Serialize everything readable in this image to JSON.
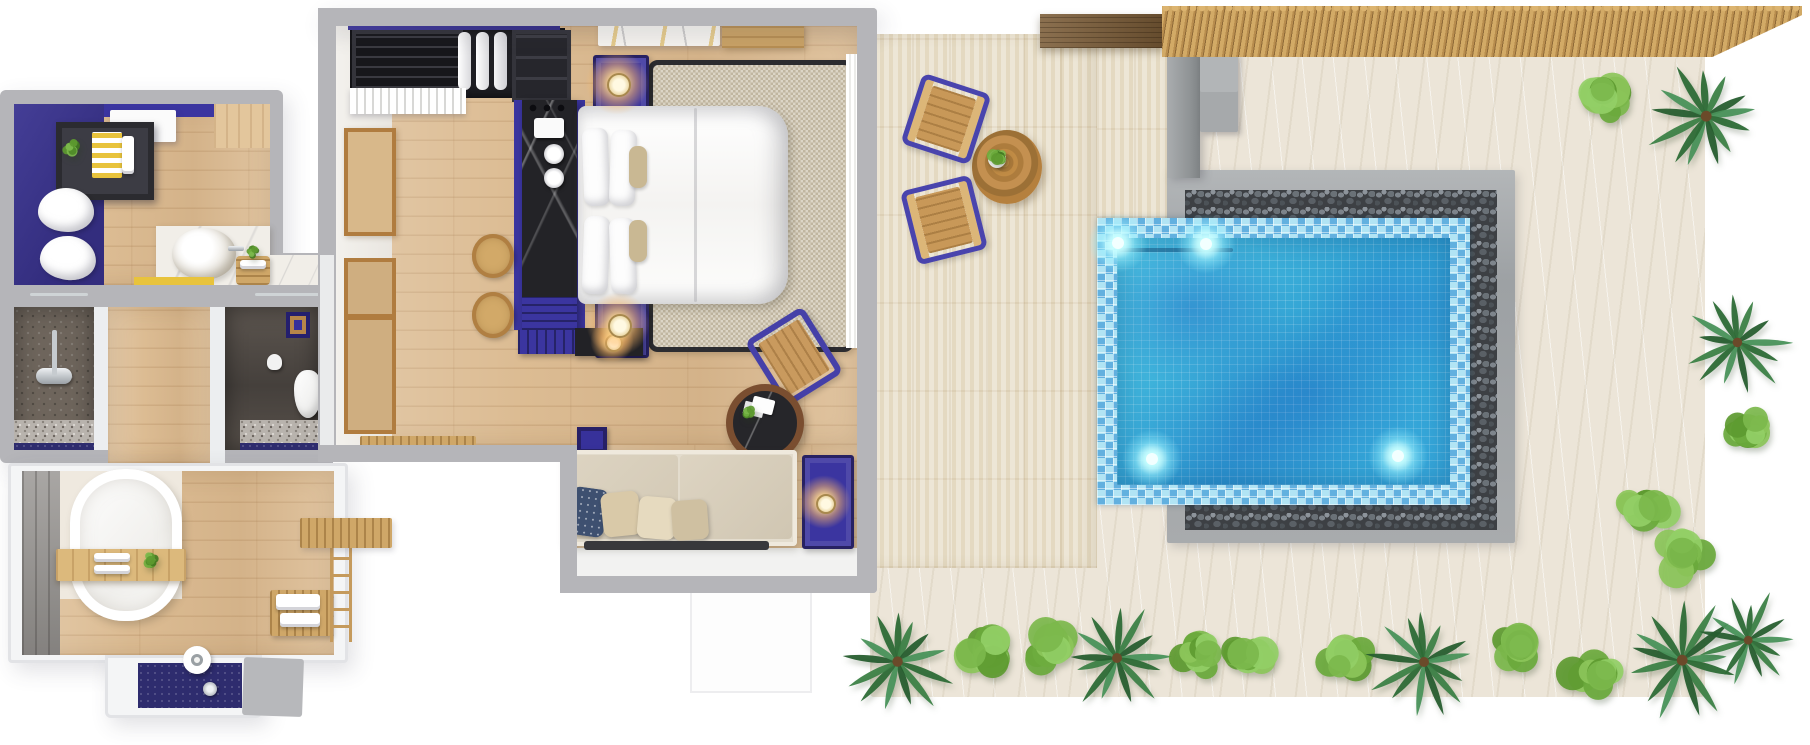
{
  "scene": {
    "type": "3d-floor-plan-render",
    "description": "Top-down 3D rendering of a one-bedroom pool villa: bathroom suite with freestanding tub and double shower rooms, bedroom with king bed and daybed sofa, travertine terrace with bistro set, bamboo-shaded sand garden with pebble-edged mosaic plunge pool and tropical planting",
    "background": "#ffffff"
  },
  "palette": {
    "wall_gray": "#b5b5b9",
    "accent_indigo": "#3b35a0",
    "indigo_dark": "#272163",
    "wood_floor": "#dcbc93",
    "travertine": "#e8dfca",
    "sand": "#ece5d8",
    "pool_water": "#35aad8",
    "pool_mosaic": "#79cde6",
    "pebble_dark": "#3d4044",
    "stone_gray": "#a8abad",
    "bamboo": "#c9a25f",
    "palm_green": "#2f6f3a",
    "shrub_green": "#7cb84c",
    "lamp_glow": "#ffd98f",
    "accent_yellow": "#e8c33c",
    "navy_tile": "#2e2c6e"
  },
  "rooms": [
    {
      "id": "vanity-bathroom",
      "name": "Vanity bathroom with robes and vessel sink"
    },
    {
      "id": "shower-room",
      "name": "Stone shower room"
    },
    {
      "id": "wc",
      "name": "Toilet room"
    },
    {
      "id": "tub-bathroom",
      "name": "Bathroom with freestanding oval tub and rain shower"
    },
    {
      "id": "bedroom",
      "name": "Bedroom with wardrobe, minibar desk, king bed and daybed"
    },
    {
      "id": "terrace",
      "name": "Travertine terrace with bistro table and chairs"
    },
    {
      "id": "pool-garden",
      "name": "Sand garden with plunge pool, pergola and outdoor shower"
    }
  ],
  "furniture": [
    "wardrobe",
    "minibar-desk",
    "kettle-tray",
    "stools",
    "king-bed",
    "nightstands",
    "bedside-lamps",
    "area-rug",
    "accent-chair",
    "coffee-table",
    "daybed-sofa",
    "dresser",
    "tv-console",
    "bathrobes",
    "vessel-sink",
    "vanity-counter",
    "shower-set",
    "toilet",
    "bathtub",
    "bath-caddy",
    "towel-bench",
    "ladder-rack",
    "rain-shower",
    "bistro-table",
    "patio-chairs",
    "sun-bench"
  ],
  "outdoor": {
    "plants": [
      {
        "kind": "palm",
        "x": 898,
        "y": 662,
        "s": 52
      },
      {
        "kind": "shrub",
        "x": 986,
        "y": 652,
        "s": 40
      },
      {
        "kind": "shrub",
        "x": 1054,
        "y": 650,
        "s": 40
      },
      {
        "kind": "palm",
        "x": 1117,
        "y": 658,
        "s": 50
      },
      {
        "kind": "shrub",
        "x": 1196,
        "y": 652,
        "s": 40
      },
      {
        "kind": "shrub",
        "x": 1248,
        "y": 658,
        "s": 36
      },
      {
        "kind": "shrub",
        "x": 1346,
        "y": 652,
        "s": 40
      },
      {
        "kind": "palm",
        "x": 1424,
        "y": 662,
        "s": 50
      },
      {
        "kind": "shrub",
        "x": 1520,
        "y": 646,
        "s": 42
      },
      {
        "kind": "shrub",
        "x": 1592,
        "y": 672,
        "s": 38
      },
      {
        "kind": "palm",
        "x": 1682,
        "y": 660,
        "s": 54
      },
      {
        "kind": "palm",
        "x": 1748,
        "y": 640,
        "s": 44
      },
      {
        "kind": "shrub",
        "x": 1600,
        "y": 100,
        "s": 40
      },
      {
        "kind": "palm",
        "x": 1706,
        "y": 116,
        "s": 54
      },
      {
        "kind": "palm",
        "x": 1737,
        "y": 342,
        "s": 48
      },
      {
        "kind": "shrub",
        "x": 1744,
        "y": 430,
        "s": 36
      },
      {
        "kind": "shrub",
        "x": 1648,
        "y": 506,
        "s": 38
      },
      {
        "kind": "shrub",
        "x": 1680,
        "y": 556,
        "s": 40
      },
      {
        "kind": "pot",
        "x": 999,
        "y": 157,
        "s": 14
      },
      {
        "kind": "pot",
        "x": 70,
        "y": 146,
        "s": 12
      },
      {
        "kind": "pot",
        "x": 253,
        "y": 252,
        "s": 9
      },
      {
        "kind": "pot",
        "x": 150,
        "y": 560,
        "s": 11
      },
      {
        "kind": "pot",
        "x": 748,
        "y": 411,
        "s": 10
      }
    ]
  },
  "pool": {
    "lights": [
      {
        "x": 1118,
        "y": 243
      },
      {
        "x": 1206,
        "y": 244
      },
      {
        "x": 1152,
        "y": 459
      },
      {
        "x": 1398,
        "y": 456
      }
    ]
  }
}
